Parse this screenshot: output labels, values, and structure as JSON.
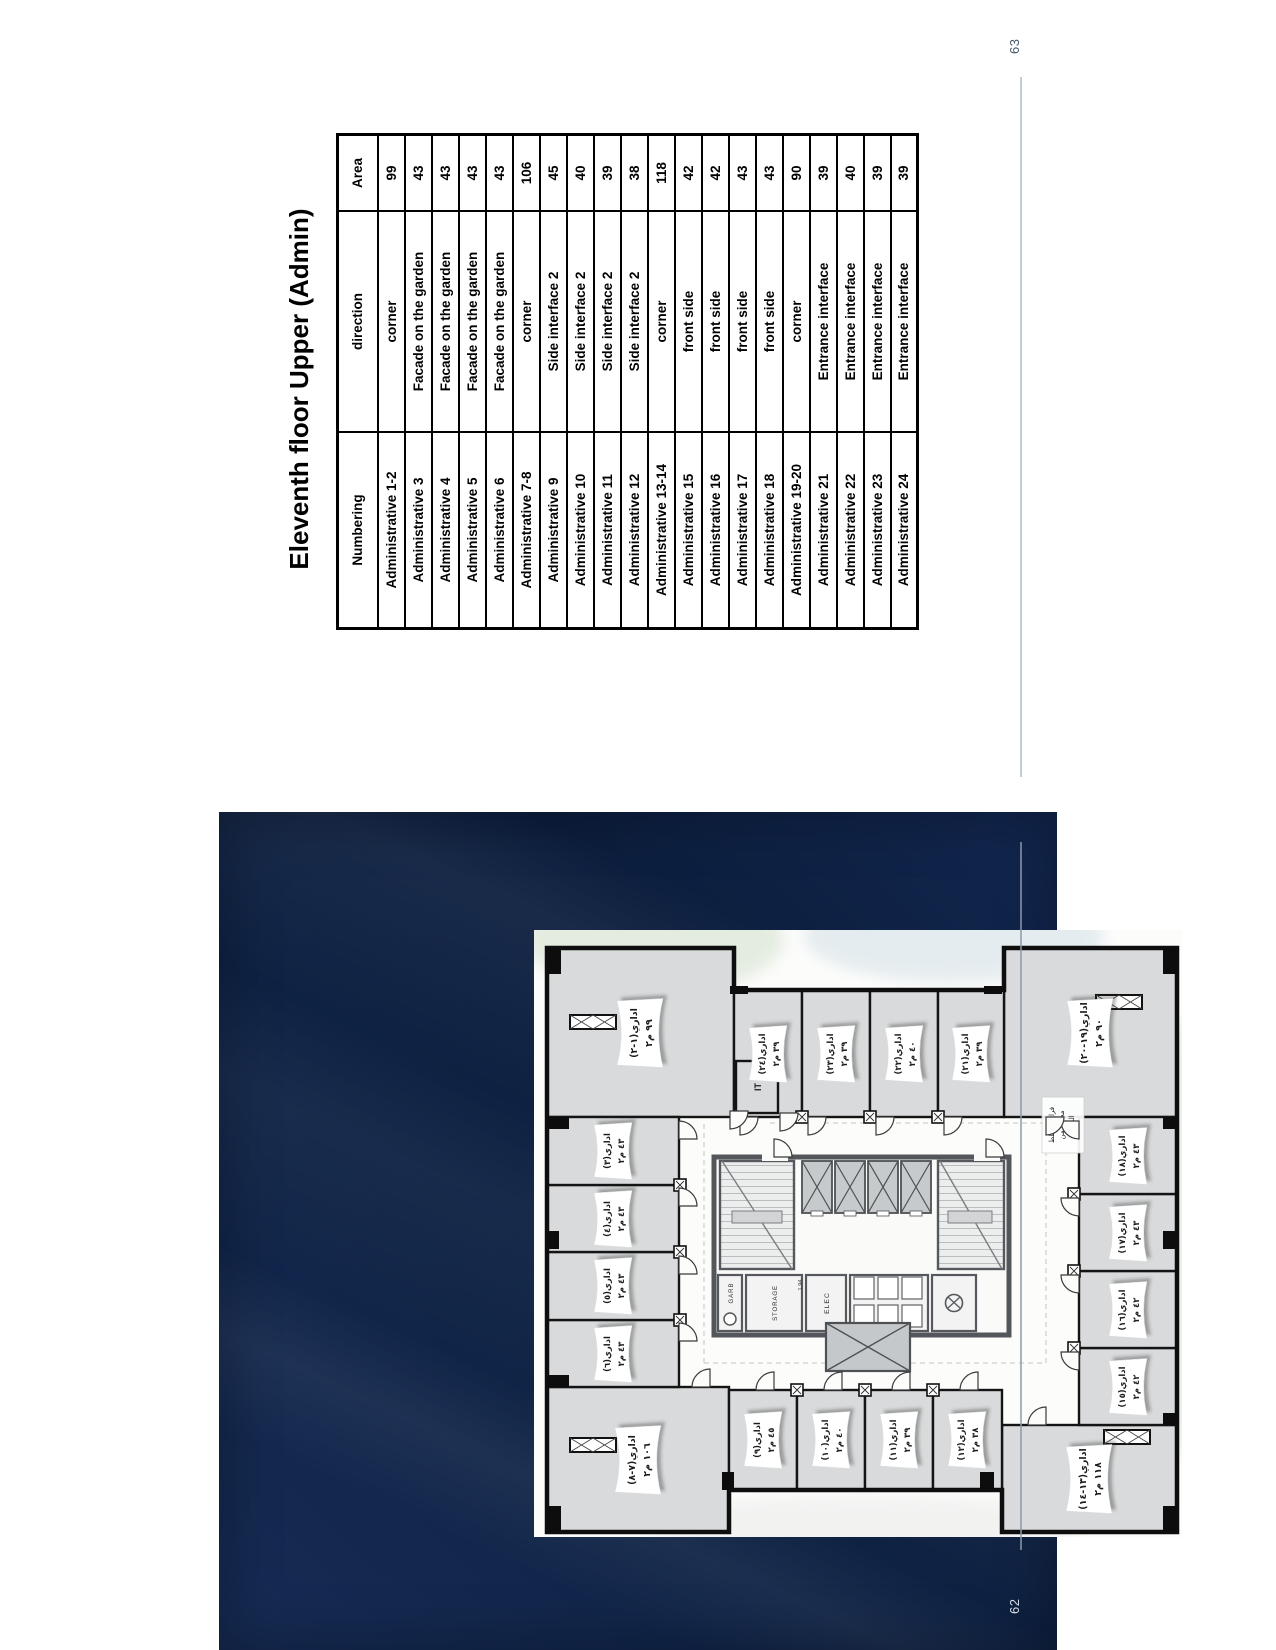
{
  "page_left": {
    "number": "62"
  },
  "page_right": {
    "number": "63",
    "title": "Eleventh floor Upper (Admin)"
  },
  "table": {
    "headers": [
      "Numbering",
      "direction",
      "Area"
    ],
    "rows": [
      [
        "Administrative 1-2",
        "corner",
        "99"
      ],
      [
        "Administrative 3",
        "Facade on the garden",
        "43"
      ],
      [
        "Administrative 4",
        "Facade on the garden",
        "43"
      ],
      [
        "Administrative 5",
        "Facade on the garden",
        "43"
      ],
      [
        "Administrative 6",
        "Facade on the garden",
        "43"
      ],
      [
        "Administrative 7-8",
        "corner",
        "106"
      ],
      [
        "Administrative 9",
        "Side interface 2",
        "45"
      ],
      [
        "Administrative 10",
        "Side interface 2",
        "40"
      ],
      [
        "Administrative 11",
        "Side interface 2",
        "39"
      ],
      [
        "Administrative 12",
        "Side interface 2",
        "38"
      ],
      [
        "Administrative 13-14",
        "corner",
        "118"
      ],
      [
        "Administrative 15",
        "front side",
        "42"
      ],
      [
        "Administrative 16",
        "front side",
        "42"
      ],
      [
        "Administrative 17",
        "front side",
        "43"
      ],
      [
        "Administrative 18",
        "front side",
        "43"
      ],
      [
        "Administrative 19-20",
        "corner",
        "90"
      ],
      [
        "Administrative 21",
        "Entrance interface",
        "39"
      ],
      [
        "Administrative 22",
        "Entrance interface",
        "40"
      ],
      [
        "Administrative 23",
        "Entrance interface",
        "39"
      ],
      [
        "Administrative 24",
        "Entrance interface",
        "39"
      ]
    ]
  },
  "floorplan": {
    "rooms": [
      {
        "id": "1-2",
        "name": "اداري(١-٢)",
        "area": "٩٩ م٢"
      },
      {
        "id": "3",
        "name": "اداري(٣)",
        "area": "٤٣ م٢"
      },
      {
        "id": "4",
        "name": "اداري(٤)",
        "area": "٤٣ م٢"
      },
      {
        "id": "5",
        "name": "اداري(٥)",
        "area": "٤٣ م٢"
      },
      {
        "id": "6",
        "name": "اداري(٦)",
        "area": "٤٣ م٢"
      },
      {
        "id": "7-8",
        "name": "اداري(٧-٨)",
        "area": "١٠٦ م٢"
      },
      {
        "id": "9",
        "name": "اداري(٩)",
        "area": "٤٥ م٢"
      },
      {
        "id": "10",
        "name": "اداري(١٠)",
        "area": "٤٠ م٢"
      },
      {
        "id": "11",
        "name": "اداري(١١)",
        "area": "٣٩ م٢"
      },
      {
        "id": "12",
        "name": "اداري(١٢)",
        "area": "٣٨ م٢"
      },
      {
        "id": "13-14",
        "name": "اداري(١٣-١٤)",
        "area": "١١٨ م٢"
      },
      {
        "id": "15",
        "name": "اداري(١٥)",
        "area": "٤٢ م٢"
      },
      {
        "id": "16",
        "name": "اداري(١٦)",
        "area": "٤٢ م٢"
      },
      {
        "id": "17",
        "name": "اداري(١٧)",
        "area": "٤٣ م٢"
      },
      {
        "id": "18",
        "name": "اداري(١٨)",
        "area": "٤٣ م٢"
      },
      {
        "id": "19-20",
        "name": "اداري(١٩-٢٠)",
        "area": "٩٠ م٢"
      },
      {
        "id": "21",
        "name": "اداري(٢١)",
        "area": "٣٩ م٢"
      },
      {
        "id": "22",
        "name": "اداري(٢٢)",
        "area": "٤٠ م٢"
      },
      {
        "id": "23",
        "name": "اداري(٢٣)",
        "area": "٣٩ م٢"
      },
      {
        "id": "24",
        "name": "اداري(٢٤)",
        "area": "٣٩ م٢"
      }
    ],
    "core_labels": {
      "it": "IT",
      "garb": "GARB",
      "storage": "STORAGE",
      "elec": "ELEC",
      "dim": "1.94"
    },
    "annotation": [
      "فراغ مخطط",
      "مخفي من",
      "الدخان"
    ]
  },
  "colors": {
    "navy": "#0f2345",
    "room_gray": "#d8dadb",
    "wall": "#141414",
    "foot_rule": "#c3ccd4"
  }
}
